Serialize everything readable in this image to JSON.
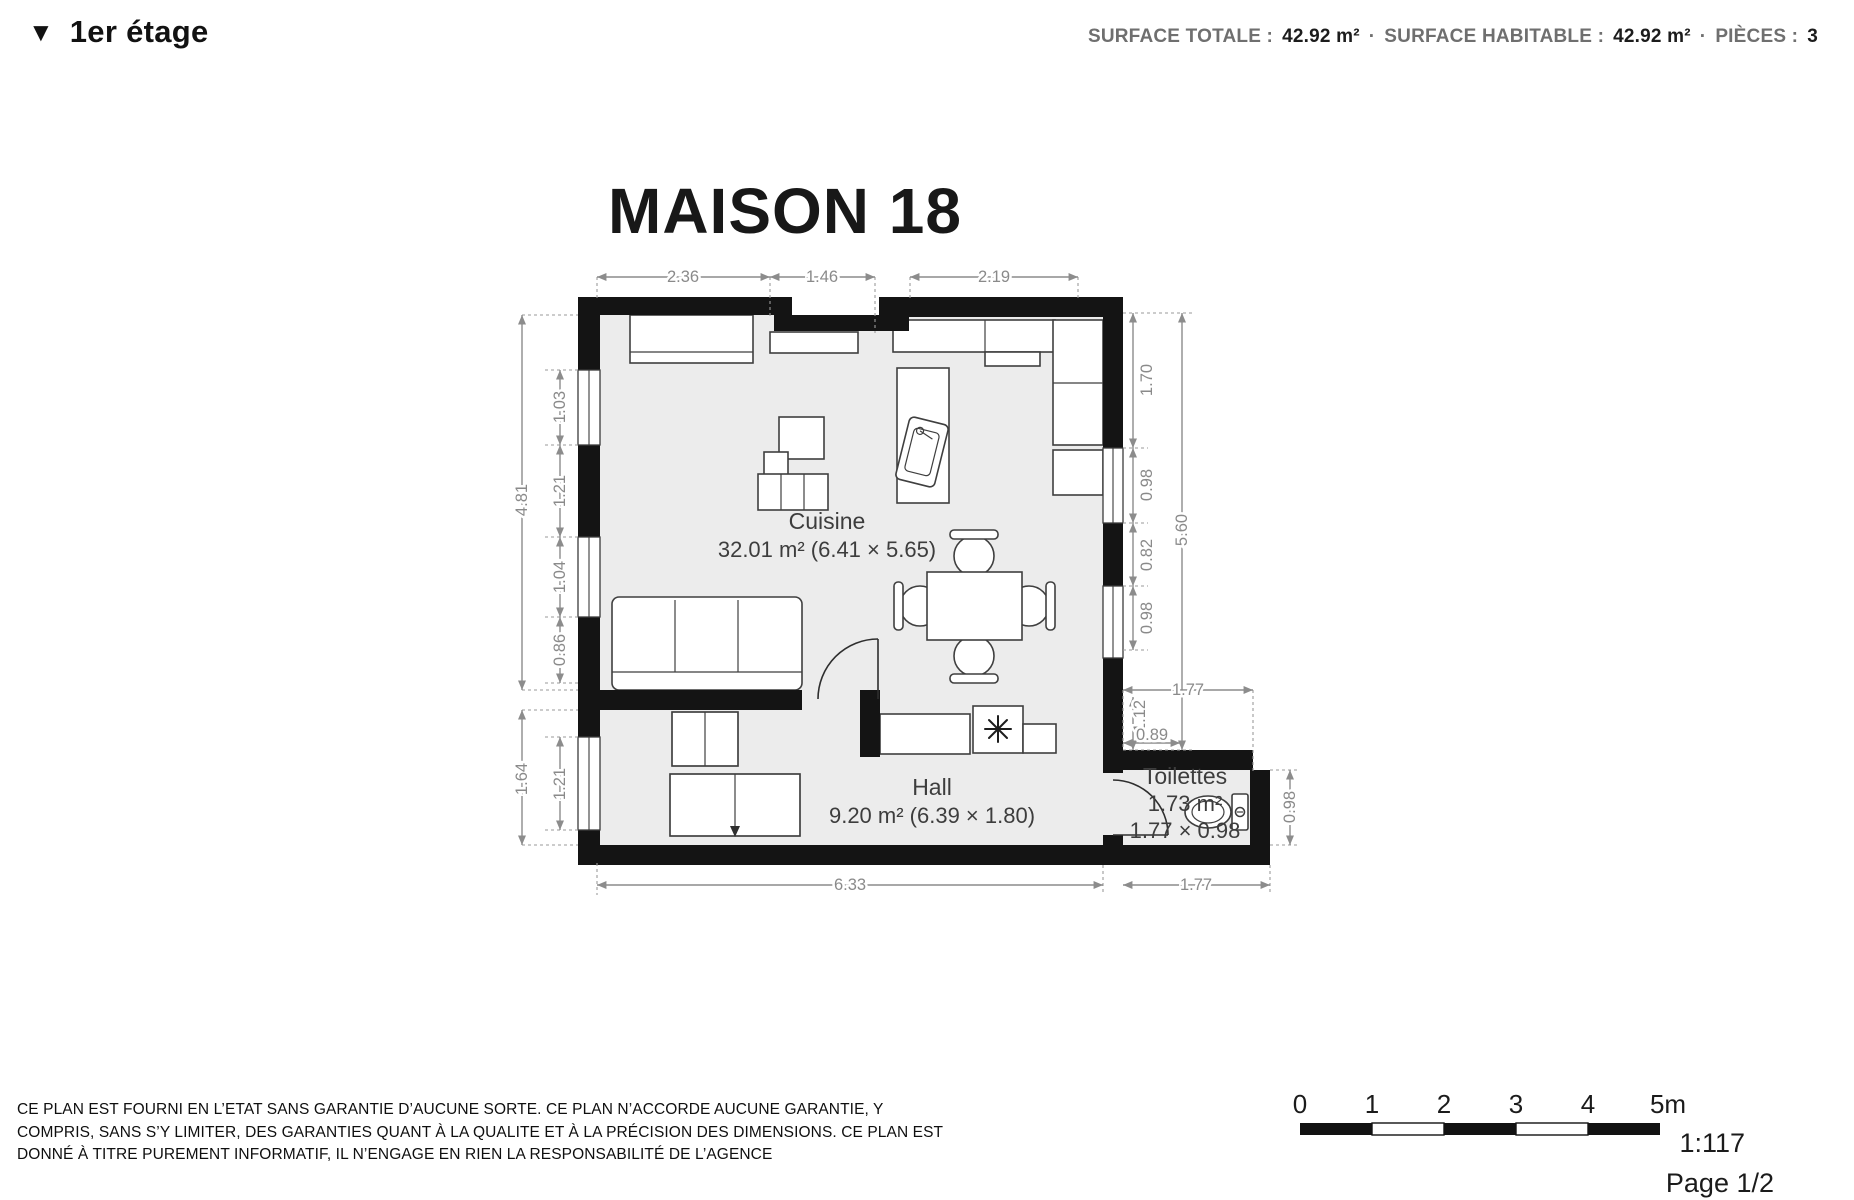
{
  "header": {
    "floor": {
      "icon": "▼",
      "label": "1er étage"
    },
    "stats": {
      "surface_totale_label": "SURFACE TOTALE :",
      "surface_totale_value": "42.92 m²",
      "sep1": "·",
      "surface_habitable_label": "SURFACE HABITABLE :",
      "surface_habitable_value": "42.92 m²",
      "sep2": "·",
      "pieces_label": "PIÈCES :",
      "pieces_value": "3"
    }
  },
  "plan": {
    "title": "MAISON 18",
    "rooms": {
      "cuisine": {
        "name": "Cuisine",
        "area": "32.01 m² (6.41 × 5.65)"
      },
      "hall": {
        "name": "Hall",
        "area": "9.20 m² (6.39 × 1.80)"
      },
      "toilettes": {
        "name": "Toilettes",
        "area": "1.73 m²",
        "size": "1.77 × 0.98"
      }
    },
    "dims": {
      "top_1": "2.36",
      "top_2": "1.46",
      "top_3": "2.19",
      "left_total": "4.81",
      "left_1": "1.03",
      "left_2": "1.21",
      "left_3": "1.04",
      "left_4": "0.86",
      "hall_left_total": "1.64",
      "hall_left_window": "1.21",
      "right_1": "1.70",
      "right_2": "0.98",
      "right_3": "0.82",
      "right_4": "0.98",
      "right_total": "5.60",
      "wc_top": "1.77",
      "wc_jog_v": "1.12",
      "wc_jog_h": "0.89",
      "wc_right": "0.98",
      "wc_bottom": "1.77",
      "bottom": "6.33"
    }
  },
  "footer": {
    "disclaimer_line1": "CE PLAN EST FOURNI EN L’ETAT SANS GARANTIE D’AUCUNE SORTE. CE PLAN N’ACCORDE AUCUNE GARANTIE, Y",
    "disclaimer_line2": "COMPRIS, SANS S’Y LIMITER, DES GARANTIES QUANT À LA QUALITE ET À LA PRÉCISION DES DIMENSIONS. CE PLAN EST",
    "disclaimer_line3": "DONNÉ À TITRE PUREMENT INFORMATIF, IL N’ENGAGE EN RIEN LA RESPONSABILITÉ DE L’AGENCE",
    "scale": {
      "t0": "0",
      "t1": "1",
      "t2": "2",
      "t3": "3",
      "t4": "4",
      "t5": "5m",
      "ratio": "1:117",
      "page": "Page 1/2"
    }
  }
}
